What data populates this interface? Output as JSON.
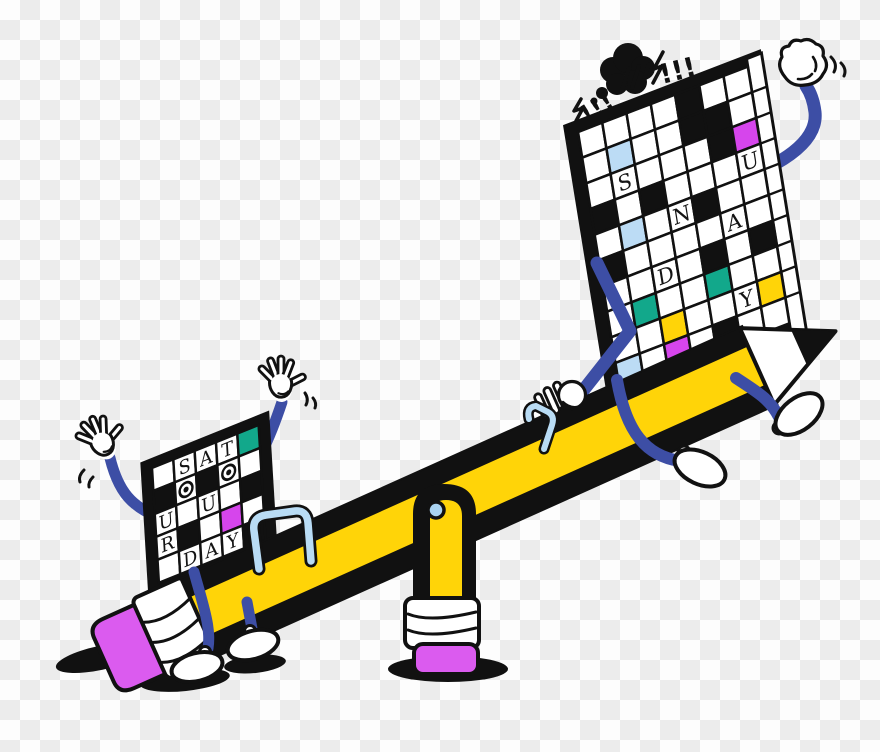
{
  "illustration": {
    "grawlix_left": "!!!",
    "grawlix_right": "!!!",
    "colors": {
      "outline": "#111111",
      "arm_blue": "#3D4EA5",
      "pencil_yellow": "#FFD408",
      "eraser_pink": "#DB5BEF",
      "cell_magenta": "#D645EC",
      "cell_teal": "#12A88B",
      "cell_lightblue": "#BCDCF5",
      "cell_yellow": "#FFD408",
      "pivot_lightblue": "#A9D3F1",
      "staple_lightblue": "#B9DCF5",
      "glove_white": "#FFFFFF",
      "checker_light": "#FDFDFD",
      "checker_dark": "#ECECEC"
    },
    "big_board": {
      "word": "SUNDAY",
      "cols": 7,
      "rows": 10,
      "cell": 26,
      "side_face": true,
      "cells": [
        [
          "w",
          "w",
          "w",
          "w",
          "k",
          "w",
          "w"
        ],
        [
          "w",
          "lb",
          "w",
          "w",
          "k",
          "k",
          "w"
        ],
        [
          "w",
          "S",
          "w",
          "w",
          "w",
          "k",
          "mg"
        ],
        [
          "k",
          "w",
          "k",
          "w",
          "w",
          "w",
          "U"
        ],
        [
          "w",
          "lb",
          "w",
          "N",
          "k",
          "w",
          "w"
        ],
        [
          "k",
          "w",
          "w",
          "w",
          "w",
          "A",
          "w"
        ],
        [
          "w",
          "w",
          "D",
          "w",
          "k",
          "w",
          "k"
        ],
        [
          "w",
          "tl",
          "w",
          "w",
          "tl",
          "w",
          "w"
        ],
        [
          "w",
          "w",
          "yl",
          "w",
          "w",
          "Y",
          "yl"
        ],
        [
          "lb",
          "w",
          "mg",
          "w",
          "k",
          "w",
          "w"
        ]
      ]
    },
    "small_board": {
      "word": "SATURDAY",
      "cols": 5,
      "rows": 5,
      "cell": 23,
      "side_face": false,
      "cells": [
        [
          "w",
          "S",
          "A",
          "T",
          "tl"
        ],
        [
          "k",
          "e",
          "k",
          "e",
          "w"
        ],
        [
          "U",
          "w",
          "U",
          "w",
          "k"
        ],
        [
          "R",
          "k",
          "w",
          "mg",
          "w"
        ],
        [
          "w",
          "D",
          "A",
          "Y",
          "k"
        ]
      ]
    }
  }
}
